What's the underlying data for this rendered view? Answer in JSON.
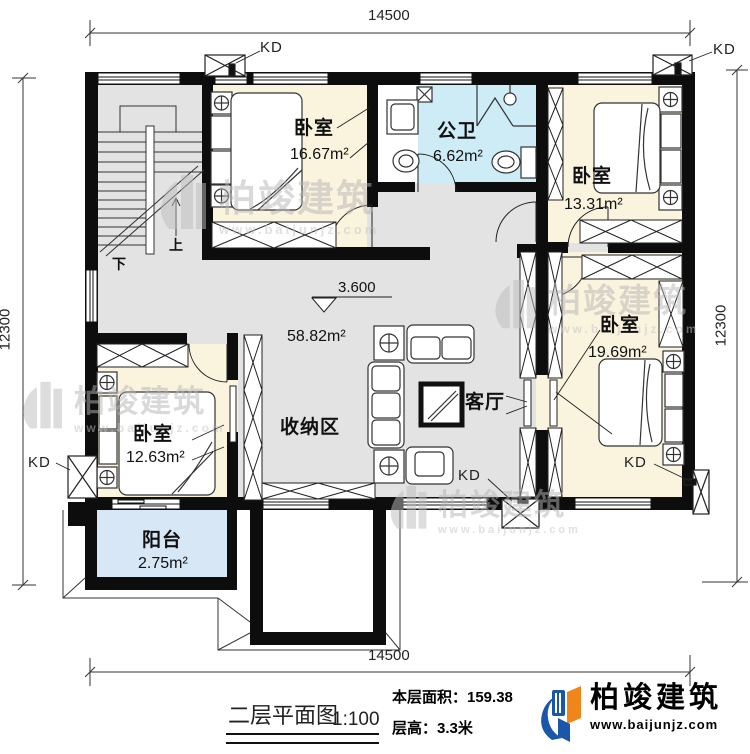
{
  "dimensions": {
    "top": "14500",
    "bottom": "14500",
    "left": "12300",
    "right": "12300"
  },
  "rooms": {
    "bedroom_top_left": {
      "name": "卧室",
      "area": "16.67m²"
    },
    "bathroom": {
      "name": "公卫",
      "area": "6.62m²"
    },
    "bedroom_top_right": {
      "name": "卧室",
      "area": "13.31m²"
    },
    "bedroom_right": {
      "name": "卧室",
      "area": "19.69m²"
    },
    "living_room": {
      "name": "客厅",
      "area": "58.82m²"
    },
    "storage_area": {
      "name": "收纳区"
    },
    "bedroom_bottom_left": {
      "name": "卧室",
      "area": "12.63m²"
    },
    "balcony": {
      "name": "阳台",
      "area": "2.75m²"
    }
  },
  "level_mark": "3.600",
  "stairs": {
    "up": "上",
    "down": "下"
  },
  "kd_label": "KD",
  "caption": {
    "title": "二层平面图",
    "scale": "1:100",
    "floor_area": "本层面积：159.38",
    "floor_height": "层高：3.3米"
  },
  "brand": {
    "name": "柏竣建筑",
    "url": "www.baijunjz.com"
  },
  "watermark": {
    "name": "柏竣建筑",
    "url": "www.baijunjz.com"
  },
  "colors": {
    "wall": "#0d0d0d",
    "floor_gray": "#e3e3e3",
    "bedroom_cream": "#faf3de",
    "bath_cyan": "#cdecf6",
    "balcony_blue": "#d8e7f6",
    "brand_blue": "#1a57a8",
    "brand_orange": "#f08519"
  }
}
